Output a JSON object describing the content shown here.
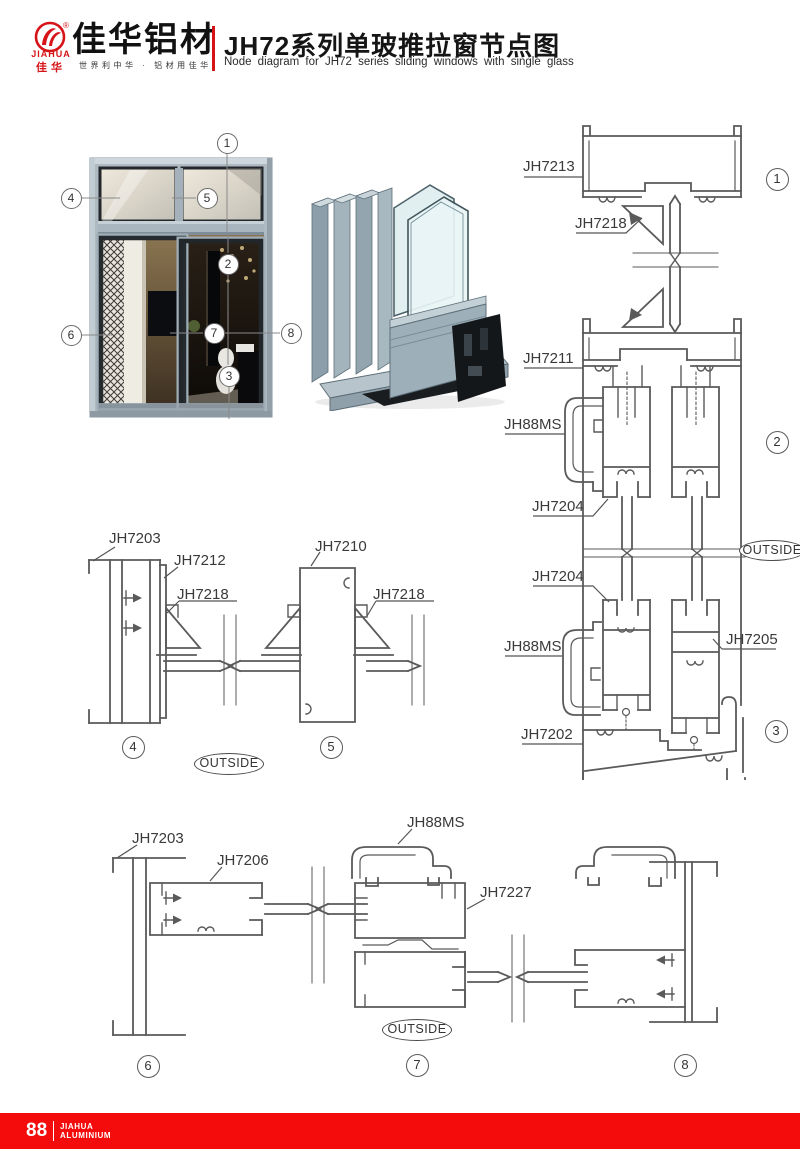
{
  "header": {
    "registered": "®",
    "logo_en": "JIAHUA",
    "logo_cn": "佳华",
    "brand_title": "佳华铝材",
    "slogan": "世界利中华 · 铝材用佳华",
    "title_cn": "JH72系列单玻推拉窗节点图",
    "title_en": "Node diagram for JH72 series sliding windows with single glass"
  },
  "colors": {
    "accent_red": "#d61418",
    "footer_red": "#f40b0b",
    "line_gray": "#5a5a5a"
  },
  "window": {
    "callouts": {
      "c1": "1",
      "c2": "2",
      "c3": "3",
      "c4": "4",
      "c5": "5",
      "c6": "6",
      "c7": "7",
      "c8": "8"
    }
  },
  "labels": {
    "outside": "OUTSIDE"
  },
  "details": {
    "d1": {
      "badge": "1",
      "frame": "JH7213",
      "wedge": "JH7218"
    },
    "d2": {
      "badge": "2",
      "midframe": "JH7211",
      "clip": "JH88MS",
      "sash": "JH7204"
    },
    "d3": {
      "badge": "3",
      "sash": "JH7204",
      "clip": "JH88MS",
      "sash_right": "JH7205",
      "sill": "JH7202"
    },
    "d4": {
      "badge": "4",
      "frame": "JH7203",
      "stile": "JH7212",
      "wedge": "JH7218"
    },
    "d5": {
      "badge": "5",
      "stile": "JH7210",
      "wedge": "JH7218"
    },
    "d6": {
      "badge": "6",
      "frame": "JH7203",
      "sash": "JH7206"
    },
    "d7": {
      "badge": "7",
      "clip": "JH88MS",
      "sash": "JH7227"
    },
    "d8": {
      "badge": "8"
    }
  },
  "footer": {
    "page_number": "88",
    "brand_line1": "JIAHUA",
    "brand_line2": "ALUMINIUM"
  }
}
